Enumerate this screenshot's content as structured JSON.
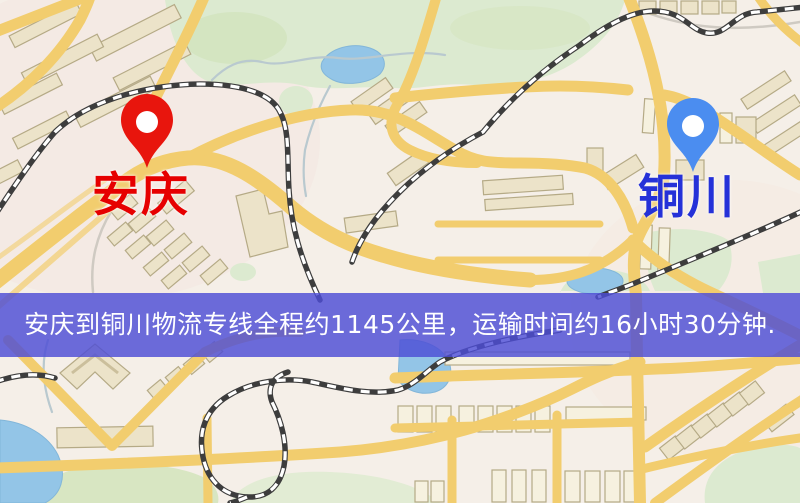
{
  "page": {
    "kind": "logistics-route-map",
    "width": 800,
    "height": 503
  },
  "markers": {
    "origin": {
      "name": "安庆",
      "pin_color": "#e8150d",
      "label_color": "#e60000"
    },
    "destination": {
      "name": "铜川",
      "pin_color": "#4b8df0",
      "label_color": "#2531d8"
    }
  },
  "banner": {
    "text": "安庆到铜川物流专线全程约1145公里，运输时间约16小时30分钟.",
    "bg_color": "#4d4dd6",
    "text_color": "#ffffff"
  },
  "map_colors": {
    "background": "#f5efe8",
    "road": "#f2cd6e",
    "park": "#dcead0",
    "water": "#93c5e7",
    "building": "#ece3c9",
    "railway": "#3d3d3d"
  }
}
